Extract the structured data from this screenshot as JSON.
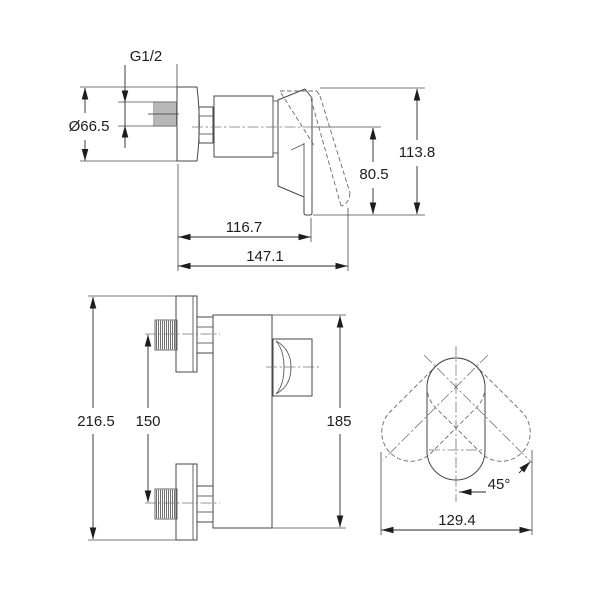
{
  "dimensions": {
    "side_view": {
      "thread_size": "G1/2",
      "flange_diameter": "Ø66.5",
      "height_total": "113.8",
      "handle_drop": "80.5",
      "depth_body": "116.7",
      "depth_total": "147.1"
    },
    "front_view": {
      "height_overall": "216.5",
      "inlet_spacing": "150",
      "body_height": "185"
    },
    "top_view": {
      "swing_angle": "45°",
      "swing_width": "129.4"
    }
  }
}
